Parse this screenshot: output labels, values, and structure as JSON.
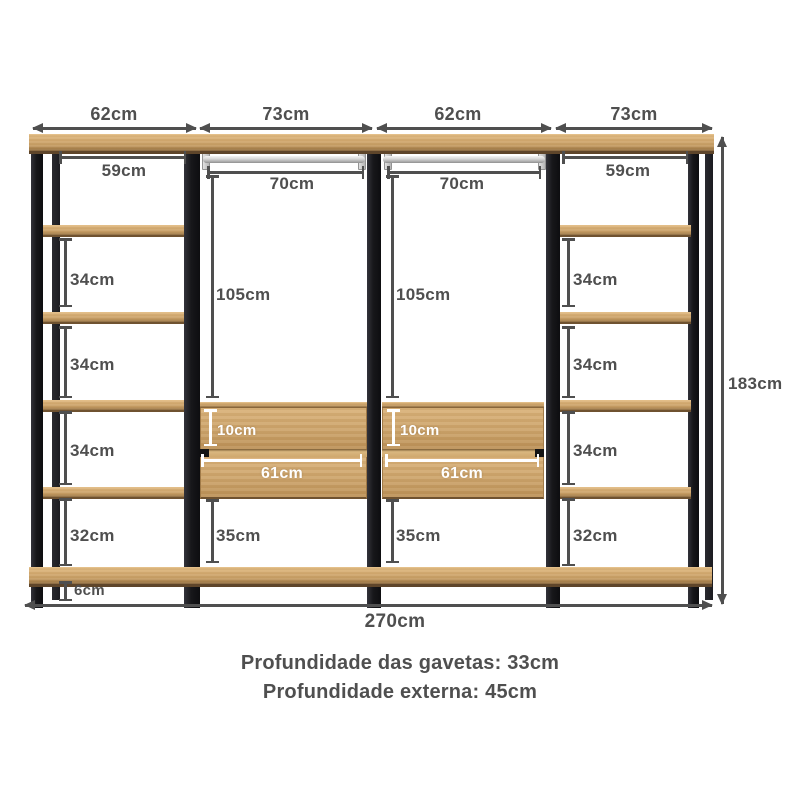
{
  "dimensions": {
    "top_sections": [
      "62cm",
      "73cm",
      "62cm",
      "73cm"
    ],
    "total_width": "270cm",
    "total_height": "183cm",
    "left_column": {
      "inner_width": "59cm",
      "gap1": "34cm",
      "gap2": "34cm",
      "gap3": "34cm",
      "gap4": "32cm",
      "floor_clearance": "6cm"
    },
    "right_column": {
      "inner_width": "59cm",
      "gap1": "34cm",
      "gap2": "34cm",
      "gap3": "34cm",
      "gap4": "32cm"
    },
    "hanging_left": {
      "rod_width": "70cm",
      "hanging_height": "105cm",
      "drawer_front_height": "10cm",
      "drawer_width": "61cm",
      "under_drawer_height": "35cm"
    },
    "hanging_right": {
      "rod_width": "70cm",
      "hanging_height": "105cm",
      "drawer_front_height": "10cm",
      "drawer_width": "61cm",
      "under_drawer_height": "35cm"
    }
  },
  "footer": {
    "line1": "Profundidade das gavetas: 33cm",
    "line2": "Profundidade externa: 45cm"
  },
  "colors": {
    "dimension_text": "#4f4f4f",
    "wood": "#cda46b",
    "frame_black": "#17171a",
    "rod_silver": "#d9d9d9",
    "drawer_dim_text": "#ffffff",
    "background": "#ffffff"
  }
}
